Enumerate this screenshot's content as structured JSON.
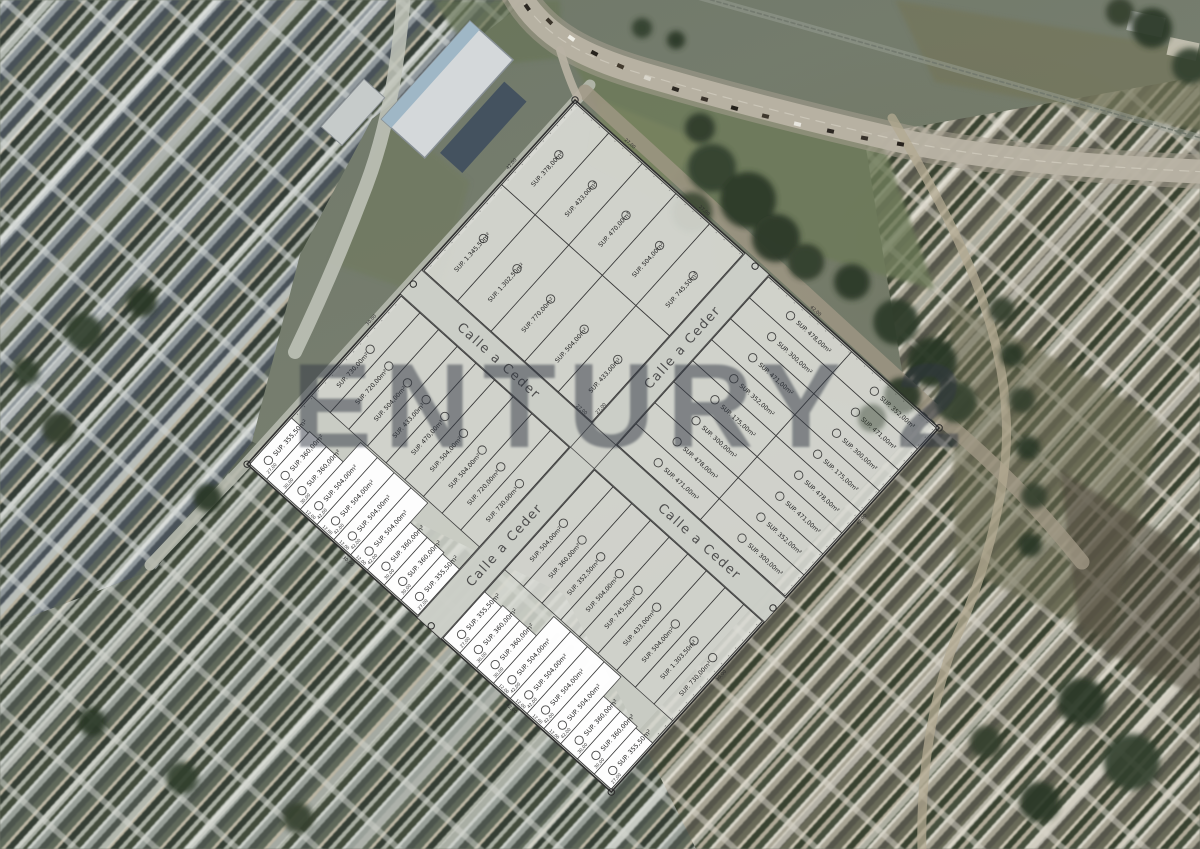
{
  "watermark": {
    "text": "ENTURY 2"
  },
  "colors": {
    "plat_fill": "#d9dbd4",
    "street_fill": "#cbcec7",
    "highlight_fill": "#ffffff",
    "line": "#3a3a3a",
    "watermark": "#303642",
    "street_text": "#4d4d4d"
  },
  "plat": {
    "origin": {
      "x": 575,
      "y": 100
    },
    "rotation": 42,
    "size": 490,
    "street_name": "Calle a Ceder",
    "street_width": 32,
    "street_center": 245,
    "street_labels": [
      {
        "axis": "h",
        "pos": 118
      },
      {
        "axis": "h",
        "pos": 388
      },
      {
        "axis": "v",
        "pos": 112
      },
      {
        "axis": "v",
        "pos": 378
      }
    ],
    "street_dims": [
      {
        "axis": "h",
        "pos": 212,
        "text": "27,00"
      },
      {
        "axis": "v",
        "pos": 212,
        "text": "27,00"
      }
    ],
    "boundary_dims": [
      {
        "edge": "top",
        "pos": 70,
        "text": "27,00"
      },
      {
        "edge": "top",
        "pos": 170,
        "text": "27,00"
      },
      {
        "edge": "top",
        "pos": 320,
        "text": "42,00"
      },
      {
        "edge": "right",
        "pos": 120,
        "text": "42,00"
      },
      {
        "edge": "right",
        "pos": 330,
        "text": "30,00"
      },
      {
        "edge": "left",
        "pos": 90,
        "text": "42,00"
      },
      {
        "edge": "left",
        "pos": 300,
        "text": "30,00"
      },
      {
        "edge": "bottom",
        "pos": 140,
        "text": "30,00"
      },
      {
        "edge": "bottom",
        "pos": 360,
        "text": "42,00"
      }
    ],
    "blocks": [
      {
        "id": "nw",
        "orient": "v",
        "u": [
          2,
          228
        ],
        "v": [
          2,
          228
        ],
        "rows": [
          {
            "from": 2,
            "to": 112,
            "lots": [
              {
                "label": "SUP. 378,00m²"
              },
              {
                "label": "SUP. 433,00m²"
              },
              {
                "label": "SUP. 470,00m²"
              },
              {
                "label": "SUP. 504,00m²"
              },
              {
                "label": "SUP. 745,50m²"
              }
            ]
          },
          {
            "from": 112,
            "to": 228,
            "lots": [
              {
                "label": "SUP. 1.345,50m²"
              },
              {
                "label": "SUP. 1.302,50m²"
              },
              {
                "label": "SUP. 770,00m²"
              },
              {
                "label": "SUP. 504,00m²"
              },
              {
                "label": "SUP. 433,00m²"
              }
            ]
          }
        ]
      },
      {
        "id": "ne",
        "orient": "u",
        "u": [
          262,
          488
        ],
        "v": [
          2,
          228
        ],
        "rows": [
          {
            "from": 262,
            "to": 374,
            "lots": [
              {
                "label": "SUP. 478,00m²"
              },
              {
                "label": "SUP. 300,00m²"
              },
              {
                "label": "SUP. 471,00m²"
              },
              {
                "label": "SUP. 352,00m²"
              },
              {
                "label": "SUP. 175,00m²"
              },
              {
                "label": "SUP. 300,00m²"
              },
              {
                "label": "SUP. 478,00m²"
              },
              {
                "label": "SUP. 471,00m²"
              }
            ]
          },
          {
            "from": 374,
            "to": 488,
            "lots": [
              {
                "label": "SUP. 352,00m²"
              },
              {
                "label": "SUP. 471,00m²"
              },
              {
                "label": "SUP. 300,00m²"
              },
              {
                "label": "SUP. 175,00m²"
              },
              {
                "label": "SUP. 478,00m²"
              },
              {
                "label": "SUP. 471,00m²"
              },
              {
                "label": "SUP. 352,00m²"
              },
              {
                "label": "SUP. 300,00m²"
              }
            ]
          }
        ]
      },
      {
        "id": "sw",
        "orient": "v",
        "u": [
          2,
          228
        ],
        "v": [
          262,
          488
        ],
        "rows": [
          {
            "from": 262,
            "to": 396,
            "lots": [
              {
                "label": "SUP. 730,00m²"
              },
              {
                "label": "SUP. 720,00m²"
              },
              {
                "label": "SUP. 504,00m²"
              },
              {
                "label": "SUP. 433,00m²"
              },
              {
                "label": "SUP. 470,00m²"
              },
              {
                "label": "SUP. 504,00m²"
              },
              {
                "label": "SUP. 504,00m²"
              },
              {
                "label": "SUP. 720,00m²"
              },
              {
                "label": "SUP. 730,00m²"
              }
            ]
          },
          {
            "from": 396,
            "to": 488,
            "white": true,
            "lots": [
              {
                "label": "SUP. 355,50m²",
                "depth": 62,
                "dim": "27,00"
              },
              {
                "label": "SUP. 360,00m²",
                "depth": 64,
                "dim": "30,00"
              },
              {
                "label": "SUP. 360,00m²",
                "depth": 64,
                "dim": "30,00"
              },
              {
                "label": "SUP. 504,00m²",
                "depth": 90,
                "dim": "42,00",
                "w": "12,00"
              },
              {
                "label": "SUP. 504,00m²",
                "depth": 90,
                "dim": "42,00",
                "w": "12,00"
              },
              {
                "label": "SUP. 504,00m²",
                "depth": 90,
                "dim": "42,00",
                "w": "12,00"
              },
              {
                "label": "SUP. 504,00m²",
                "depth": 90,
                "dim": "42,00",
                "w": "12,00"
              },
              {
                "label": "SUP. 360,00m²",
                "depth": 64,
                "dim": "30,00"
              },
              {
                "label": "SUP. 360,00m²",
                "depth": 64,
                "dim": "30,00"
              },
              {
                "label": "SUP. 355,50m²",
                "depth": 62,
                "dim": "27,00"
              }
            ]
          }
        ]
      },
      {
        "id": "se",
        "orient": "v",
        "u": [
          262,
          488
        ],
        "v": [
          262,
          488
        ],
        "rows": [
          {
            "from": 262,
            "to": 396,
            "lots": [
              {
                "label": "SUP. 504,00m²"
              },
              {
                "label": "SUP. 360,00m²"
              },
              {
                "label": "SUP. 352,50m²"
              },
              {
                "label": "SUP. 504,00m²"
              },
              {
                "label": "SUP. 745,50m²"
              },
              {
                "label": "SUP. 433,00m²"
              },
              {
                "label": "SUP. 504,00m²"
              },
              {
                "label": "SUP. 1.303,50m²"
              },
              {
                "label": "SUP. 730,00m²"
              }
            ]
          },
          {
            "from": 396,
            "to": 488,
            "white": true,
            "lots": [
              {
                "label": "SUP. 355,50m²",
                "depth": 62,
                "dim": "27,00"
              },
              {
                "label": "SUP. 360,00m²",
                "depth": 64,
                "dim": "30,00"
              },
              {
                "label": "SUP. 360,00m²",
                "depth": 64,
                "dim": "30,00"
              },
              {
                "label": "SUP. 504,00m²",
                "depth": 90,
                "dim": "42,00",
                "w": "12,00"
              },
              {
                "label": "SUP. 504,00m²",
                "depth": 90,
                "dim": "42,00",
                "w": "12,00"
              },
              {
                "label": "SUP. 504,00m²",
                "depth": 90,
                "dim": "42,00",
                "w": "12,00"
              },
              {
                "label": "SUP. 504,00m²",
                "depth": 90,
                "dim": "42,00",
                "w": "12,00"
              },
              {
                "label": "SUP. 360,00m²",
                "depth": 64,
                "dim": "30,00"
              },
              {
                "label": "SUP. 360,00m²",
                "depth": 64,
                "dim": "30,00"
              },
              {
                "label": "SUP. 355,50m²",
                "depth": 62,
                "dim": "27,00"
              }
            ]
          }
        ]
      }
    ]
  }
}
